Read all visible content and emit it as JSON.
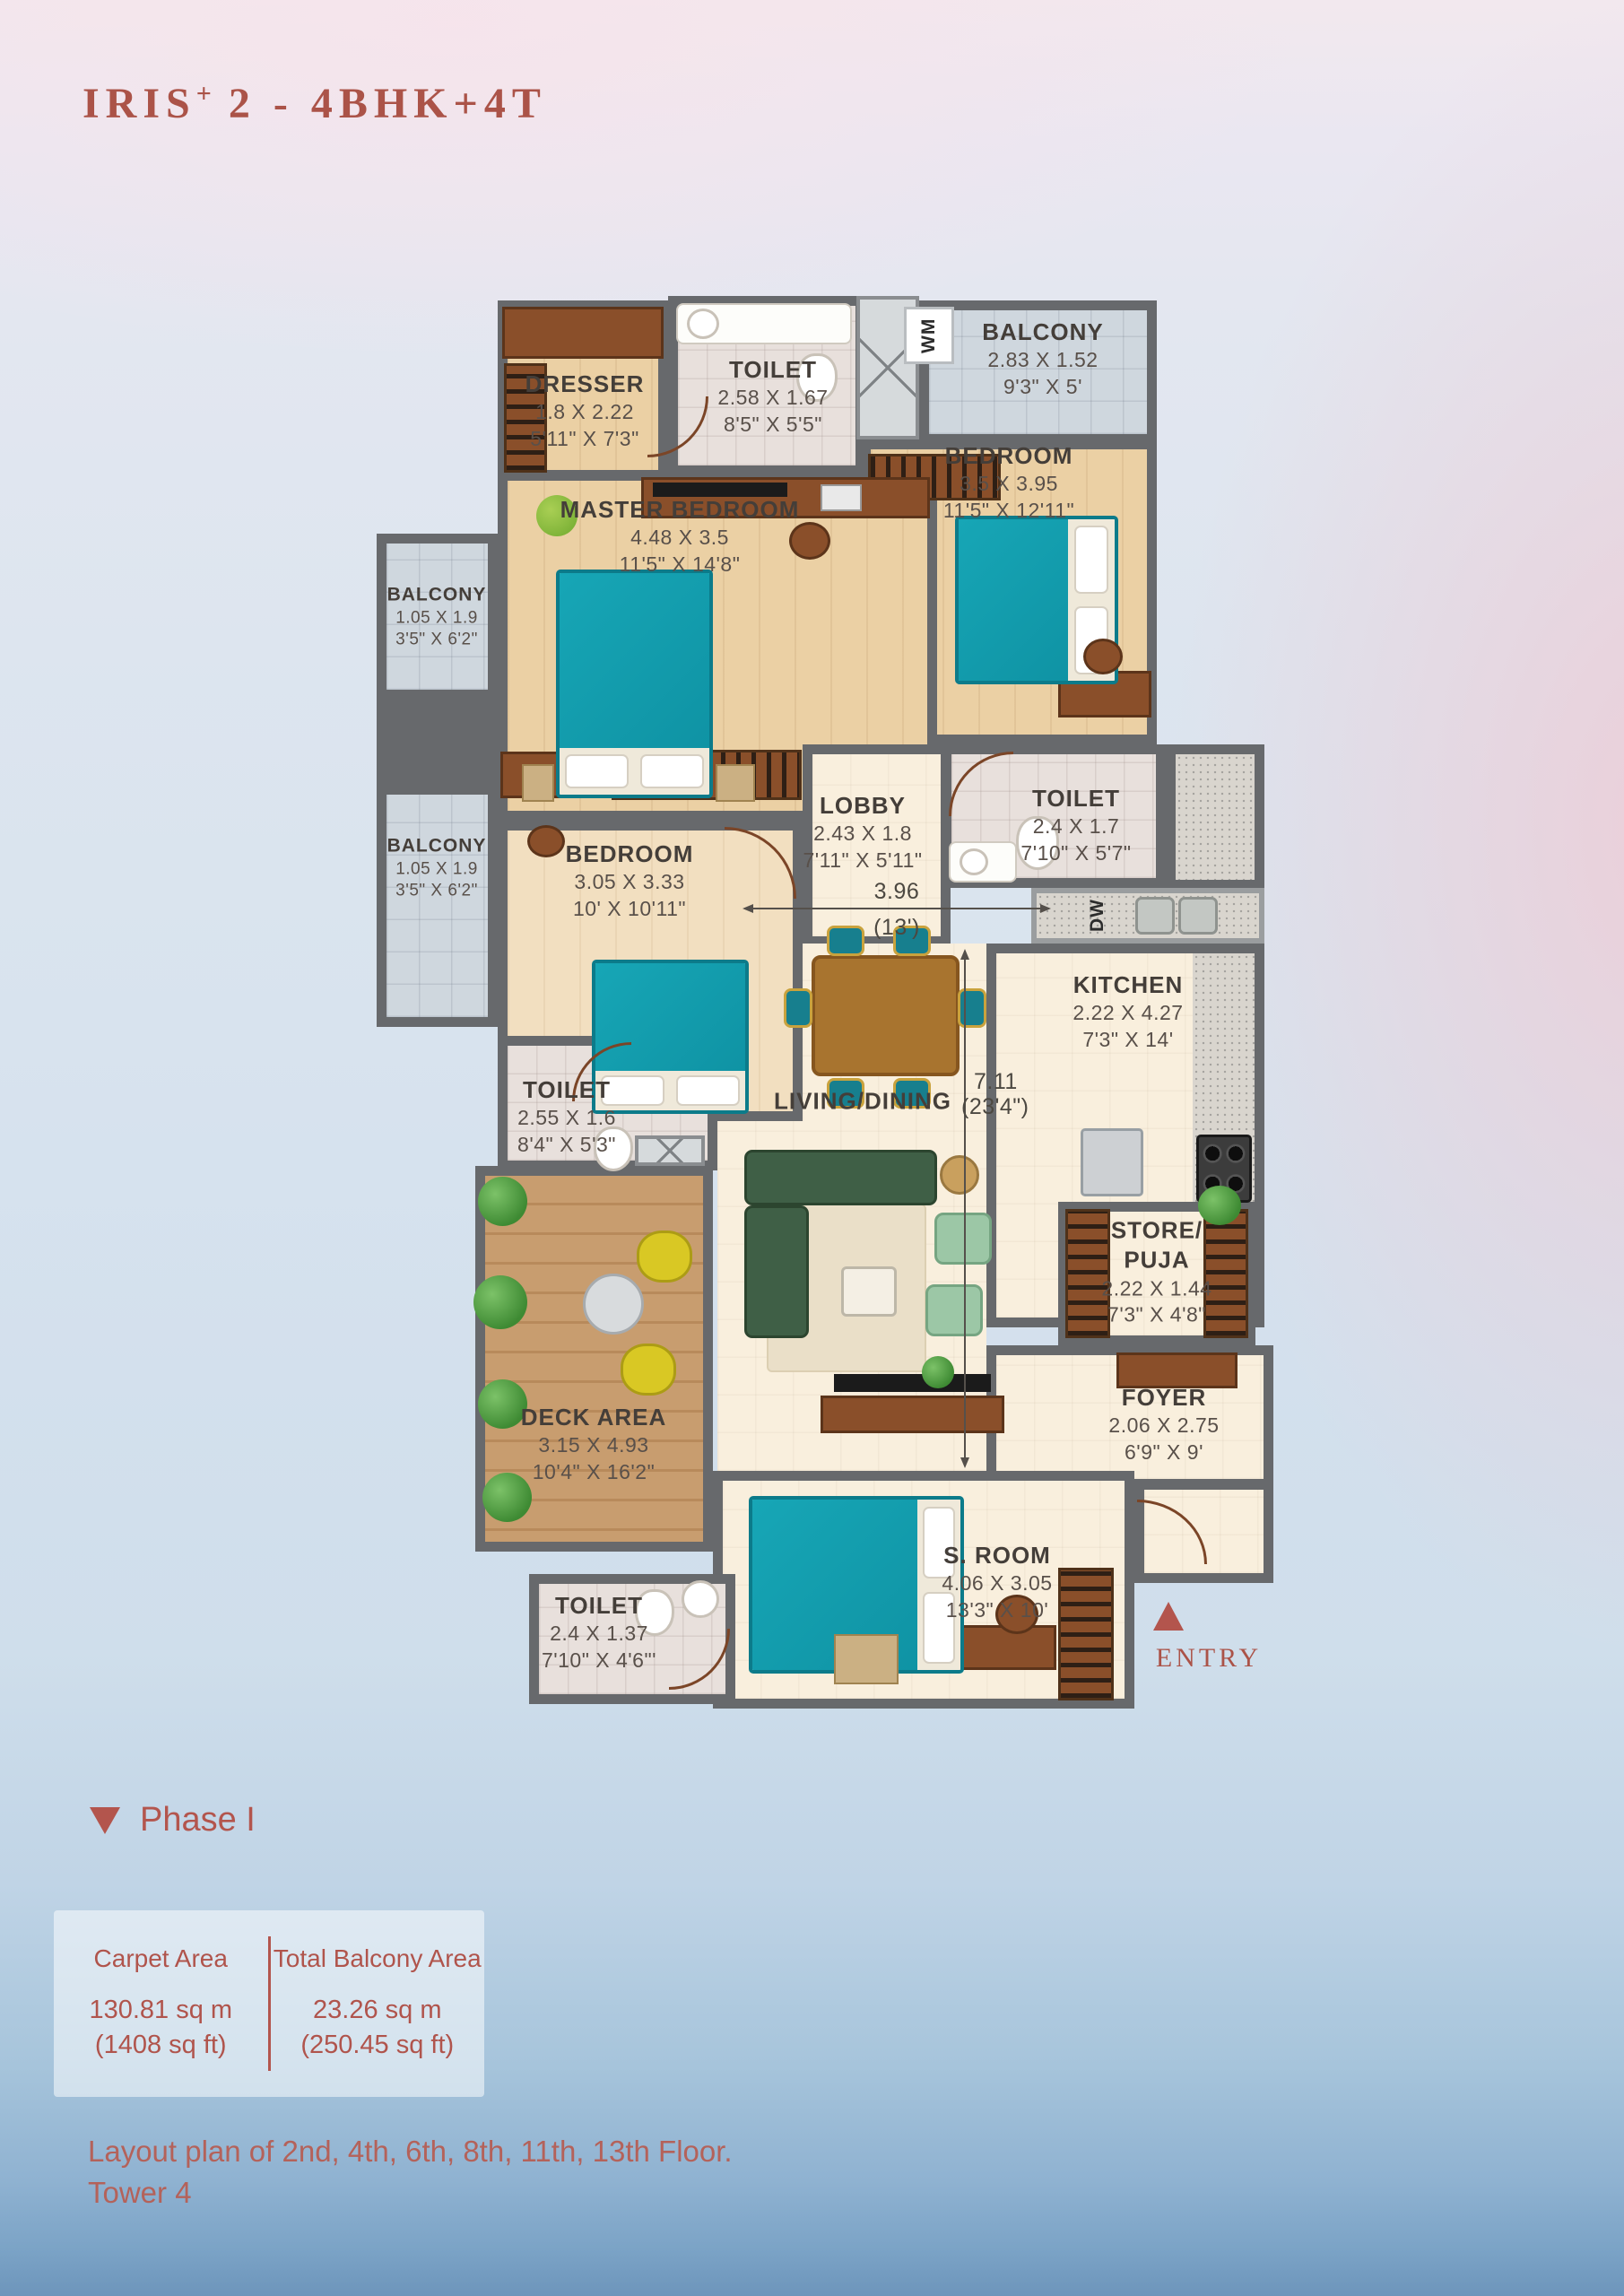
{
  "header": {
    "title_main": "IRIS",
    "title_sup": "+",
    "title_rest": " 2 - 4BHK+4T"
  },
  "plan": {
    "dresser": {
      "name": "DRESSER",
      "m": "1.8 X 2.22",
      "ft": "5'11\" X 7'3\""
    },
    "toilet_master": {
      "name": "TOILET",
      "m": "2.58 X 1.67",
      "ft": "8'5\" X 5'5\""
    },
    "wm": "WM",
    "balcony_top": {
      "name": "BALCONY",
      "m": "2.83 X 1.52",
      "ft": "9'3\" X 5'"
    },
    "bedroom_top": {
      "name": "BEDROOM",
      "m": "3.5 X 3.95",
      "ft": "11'5\" X 12'11\""
    },
    "master": {
      "name": "MASTER BEDROOM",
      "m": "4.48 X 3.5",
      "ft": "11'5\" X 14'8\""
    },
    "balcony1": {
      "name": "BALCONY",
      "m": "1.05 X 1.9",
      "ft": "3'5\" X 6'2\""
    },
    "bedroom_mid": {
      "name": "BEDROOM",
      "m": "3.05 X 3.33",
      "ft": "10' X 10'11\""
    },
    "lobby": {
      "name": "LOBBY",
      "m": "2.43 X 1.8",
      "ft": "7'11\" X 5'11\""
    },
    "toilet_mid": {
      "name": "TOILET",
      "m": "2.4 X 1.7",
      "ft": "7'10\" X 5'7\""
    },
    "balcony2": {
      "name": "BALCONY",
      "m": "1.05 X 1.9",
      "ft": "3'5\" X 6'2\""
    },
    "dw": "DW",
    "kitchen": {
      "name": "KITCHEN",
      "m": "2.22 X 4.27",
      "ft": "7'3\" X 14'"
    },
    "toilet_left": {
      "name": "TOILET",
      "m": "2.55 X 1.6",
      "ft": "8'4\" X 5'3\""
    },
    "living": {
      "name": "LIVING/DINING"
    },
    "dim_w": {
      "m": "3.96",
      "ft": "(13')"
    },
    "dim_h": {
      "m": "7.11",
      "ft": "(23'4\")"
    },
    "store": {
      "name1": "STORE/",
      "name2": "PUJA",
      "m": "2.22 X 1.44",
      "ft": "7'3\" X 4'8\""
    },
    "foyer": {
      "name": "FOYER",
      "m": "2.06 X 2.75",
      "ft": "6'9\" X 9'"
    },
    "deck": {
      "name": "DECK AREA",
      "m": "3.15 X 4.93",
      "ft": "10'4\" X 16'2\""
    },
    "toilet_bottom": {
      "name": "TOILET",
      "m": "2.4 X 1.37",
      "ft": "7'10\" X 4'6\"'"
    },
    "sroom": {
      "name": "S. ROOM",
      "m": "4.06 X 3.05",
      "ft": "13'3\" X 10'"
    },
    "entry": "ENTRY"
  },
  "footer": {
    "phase": "Phase I",
    "carpet_label": "Carpet Area",
    "carpet_m": "130.81 sq m",
    "carpet_ft": "(1408 sq ft)",
    "balcony_label": "Total Balcony Area",
    "balcony_m": "23.26 sq m",
    "balcony_ft": "(250.45 sq ft)",
    "note1": "Layout plan of 2nd, 4th, 6th, 8th, 11th, 13th Floor.",
    "note2": "Tower 4"
  },
  "colors": {
    "accent": "#b0544c",
    "wall": "#67696c",
    "bed_teal": "#149fb1"
  }
}
